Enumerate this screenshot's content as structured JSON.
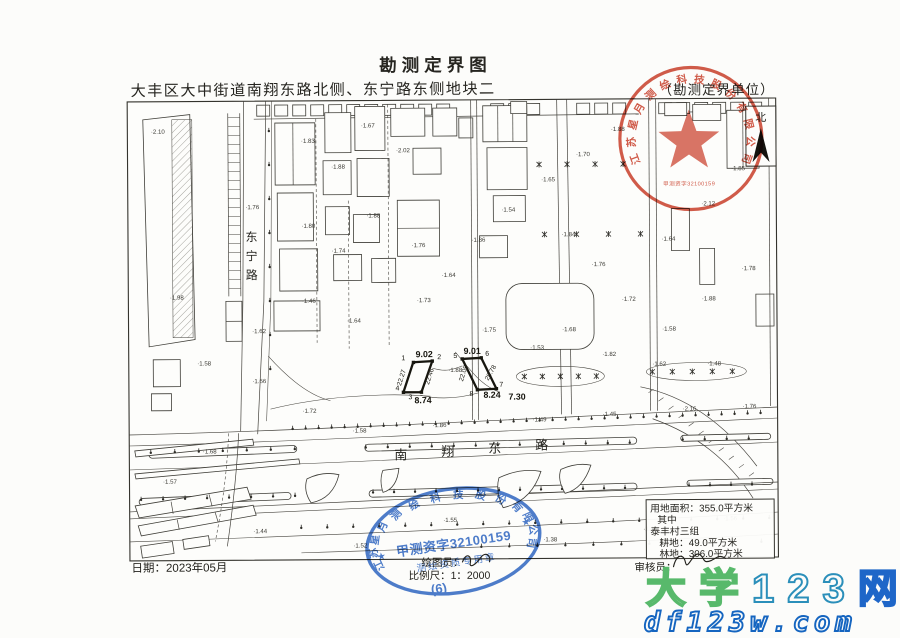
{
  "sheet": {
    "title": "勘测定界图",
    "subtitle": "大丰区大中街道南翔东路北侧、东宁路东侧地块二",
    "unit_label": "（勘测定界单位）",
    "north_label": "北",
    "date": "日期：2023年05月",
    "drafter_label": "绘图员：",
    "scale_label": "比例尺：1：2000",
    "reviewer_label": "审核员：",
    "sheet_no": "(6)"
  },
  "roads": {
    "east_ning": "东宁路",
    "nanxiang_east": "南翔东路"
  },
  "parcels": {
    "left": {
      "top_elev": "9.02",
      "bottom_elev": "8.74",
      "c1": "1",
      "c2": "2",
      "c3": "3",
      "c4": "4",
      "dim_left": "22.27",
      "dim_right": "22.46"
    },
    "right": {
      "top_elev": "9.01",
      "bottom_elev": "8.24",
      "c5": "5",
      "c6": "6",
      "c7": "7",
      "c8": "8",
      "dim_left": "22.09",
      "dim_right": "28.78",
      "spot": "7.30"
    }
  },
  "info_box": {
    "area": "用地面积：355.0平方米",
    "among": "其中",
    "village": "泰丰村三组",
    "farmland": "耕地：49.0平方米",
    "forest": "林地：306.0平方米"
  },
  "red_stamp": {
    "company": "江苏星月测绘科技股份有限公司",
    "code": "甲测资字32100159"
  },
  "blue_stamp": {
    "company": "江苏星月测绘科技股份有限公司",
    "code": "甲测资字32100159",
    "subtitle": "测绘资质专用章"
  },
  "watermark": {
    "cn1": "大学",
    "cn2": "123",
    "cn3": "网",
    "url": "df123w.com",
    "green": "#58b96b",
    "teal": "#2b8fba",
    "blue": "#1e66c8"
  },
  "spot_elevations": [
    [
      152,
      132,
      "2.10"
    ],
    [
      170,
      298,
      "1.98"
    ],
    [
      197,
      364,
      "1.58"
    ],
    [
      246,
      208,
      "1.76"
    ],
    [
      252,
      332,
      "1.62"
    ],
    [
      302,
      142,
      "1.83"
    ],
    [
      332,
      168,
      "1.88"
    ],
    [
      362,
      127,
      "1.67"
    ],
    [
      397,
      152,
      "2.02"
    ],
    [
      302,
      227,
      "1.80"
    ],
    [
      332,
      252,
      "1.74"
    ],
    [
      367,
      217,
      "1.88"
    ],
    [
      412,
      247,
      "1.76"
    ],
    [
      302,
      302,
      "1.46"
    ],
    [
      347,
      322,
      "1.64"
    ],
    [
      417,
      302,
      "1.73"
    ],
    [
      442,
      277,
      "1.64"
    ],
    [
      472,
      242,
      "1.86"
    ],
    [
      502,
      212,
      "1.54"
    ],
    [
      542,
      182,
      "1.65"
    ],
    [
      577,
      157,
      "1.70"
    ],
    [
      612,
      132,
      "1.88"
    ],
    [
      562,
      237,
      "1.84"
    ],
    [
      592,
      267,
      "1.76"
    ],
    [
      622,
      302,
      "1.72"
    ],
    [
      662,
      332,
      "1.58"
    ],
    [
      702,
      302,
      "1.88"
    ],
    [
      742,
      272,
      "1.78"
    ],
    [
      702,
      207,
      "2.12"
    ],
    [
      732,
      172,
      "1.85"
    ],
    [
      662,
      242,
      "1.64"
    ],
    [
      562,
      332,
      "1.68"
    ],
    [
      602,
      357,
      "1.82"
    ],
    [
      652,
      367,
      "1.62"
    ],
    [
      707,
      367,
      "1.48"
    ],
    [
      302,
      412,
      "1.72"
    ],
    [
      352,
      432,
      "1.58"
    ],
    [
      432,
      427,
      "1.86"
    ],
    [
      532,
      422,
      "1.49"
    ],
    [
      602,
      417,
      "1.45"
    ],
    [
      682,
      412,
      "2.16"
    ],
    [
      742,
      410,
      "1.76"
    ],
    [
      202,
      452,
      "1.68"
    ],
    [
      162,
      482,
      "1.57"
    ],
    [
      252,
      532,
      "1.44"
    ],
    [
      352,
      547,
      "1.52"
    ],
    [
      442,
      522,
      "1.55"
    ],
    [
      542,
      542,
      "1.38"
    ],
    [
      642,
      532,
      "1.45"
    ],
    [
      722,
      522,
      "1.56"
    ],
    [
      252,
      382,
      "1.66"
    ],
    [
      482,
      332,
      "1.75"
    ],
    [
      448,
      372,
      "1.88"
    ],
    [
      530,
      350,
      "1.53"
    ]
  ]
}
